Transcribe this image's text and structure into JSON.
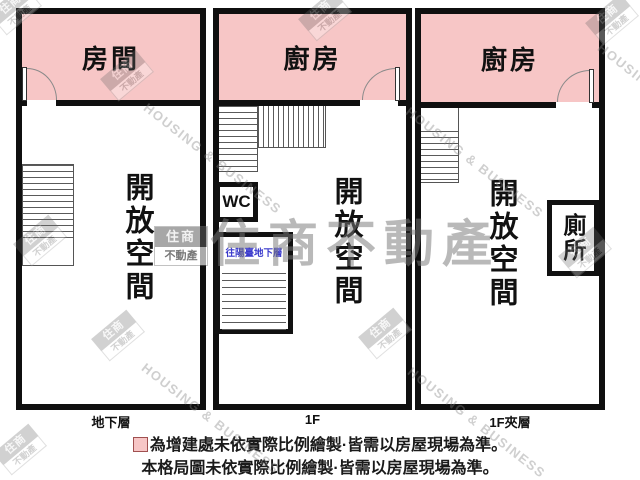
{
  "panels": [
    {
      "room_label": "房間",
      "open_space": "開放空間",
      "floor_label": "地下層"
    },
    {
      "room_label": "廚房",
      "wc_label": "WC",
      "stair_note": "往陽臺地下層",
      "open_space": "開放空間",
      "floor_label": "1F"
    },
    {
      "room_label": "廚房",
      "toilet_label": "廁所",
      "open_space": "開放空間",
      "floor_label": "1F夾層"
    }
  ],
  "legend": {
    "line1": "為增建處未依實際比例繪製·皆需以房屋現場為準。",
    "line2": "本格局圖未依實際比例繪製·皆需以房屋現場為準。"
  },
  "watermark": {
    "logo_top": "住商",
    "logo_bottom": "不動產",
    "big_text": "住商不動產",
    "diagonal_text": "HOUSING & BUSINESS"
  },
  "colors": {
    "room_pink": "#f7c6c6",
    "wall_black": "#0f0f0f",
    "note_blue": "#3a3acc",
    "watermark_gray": "#9a9a9a"
  }
}
